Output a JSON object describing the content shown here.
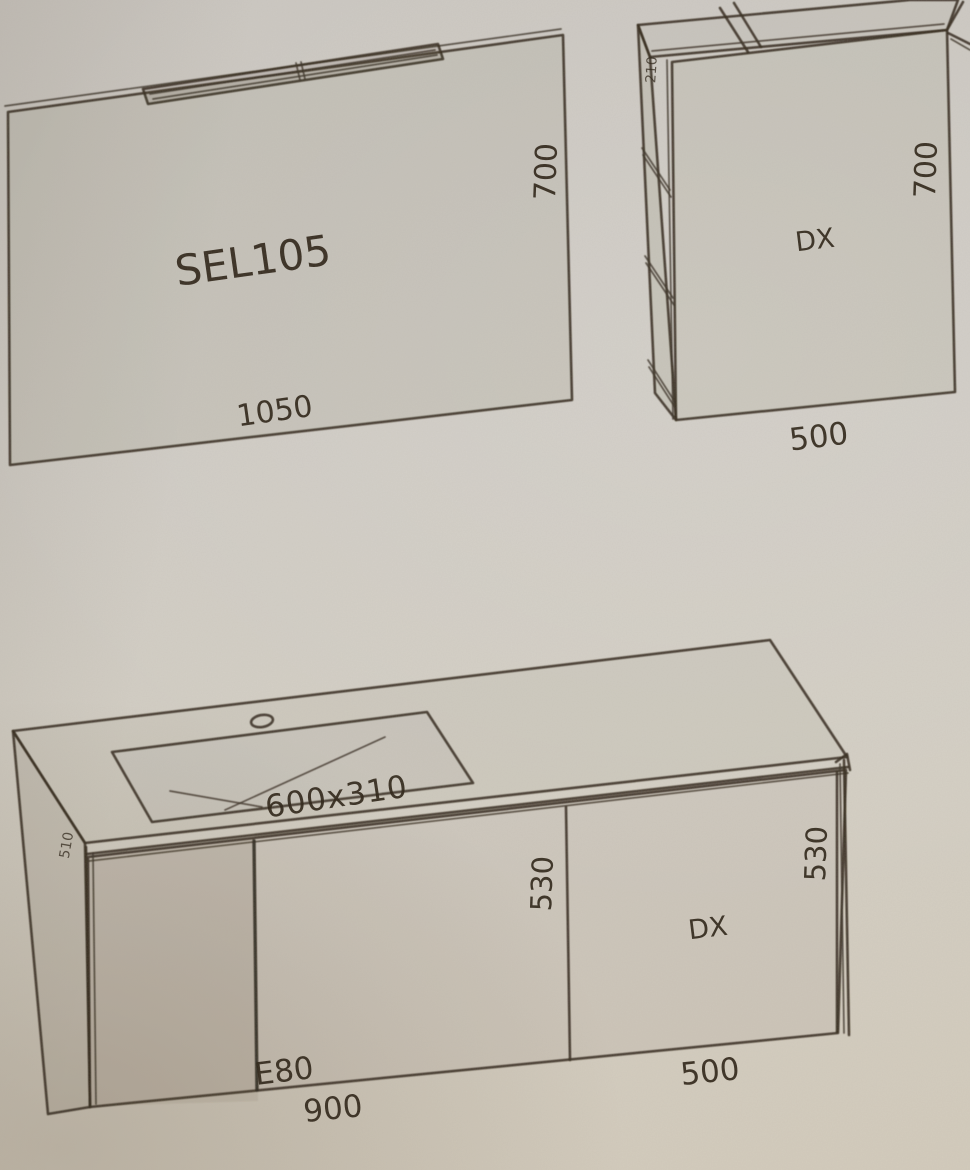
{
  "drawing": {
    "mirror": {
      "model": "SEL105",
      "width": "1050",
      "height": "700"
    },
    "wall_unit": {
      "depth": "210",
      "door": "DX",
      "height": "700",
      "width": "500"
    },
    "base_unit": {
      "basin": "600x310",
      "depth": "510",
      "code": "E80",
      "height_center": "530",
      "height_right": "530",
      "door": "DX",
      "width": "900",
      "door_width": "500"
    }
  },
  "colors": {
    "paper": "#d1ccc3",
    "ink": "#2b2215"
  }
}
